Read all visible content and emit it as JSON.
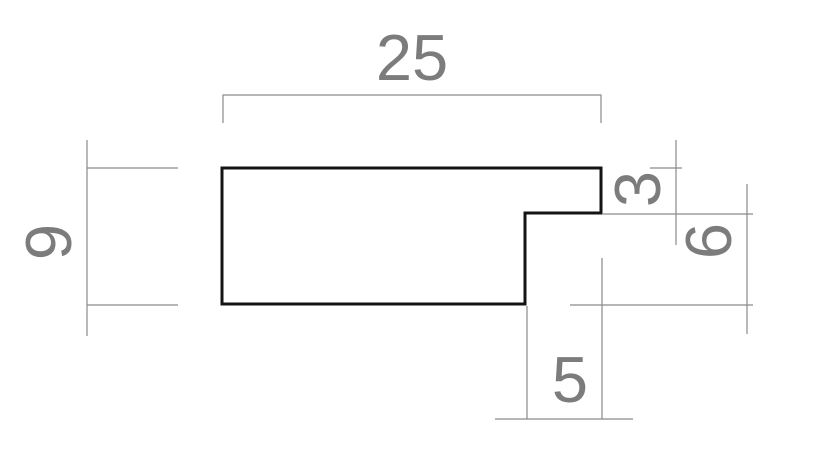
{
  "drawing": {
    "labels": {
      "total_width": "25",
      "total_height": "9",
      "top_lip_thickness": "3",
      "rabbet_height": "6",
      "rabbet_width": "5"
    },
    "colors": {
      "outline": "#141414",
      "dimension_lines": "#8a8a8a",
      "dimension_text": "#7c7c7c",
      "background": "#ffffff"
    }
  }
}
